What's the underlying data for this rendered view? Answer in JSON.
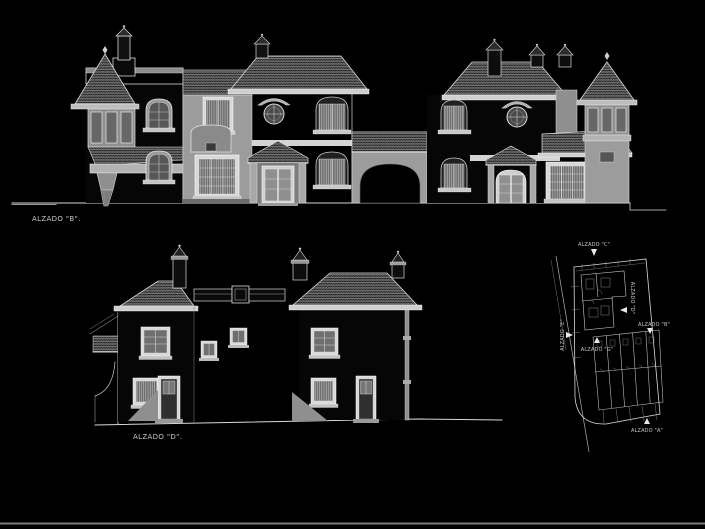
{
  "window": {
    "bottom_edge_color": "#7a7a7a"
  },
  "drawing": {
    "background": "#000000",
    "line_color": "#d9d9d9",
    "wall_fill": "#9c9c9c",
    "roof_tile_line": "#c9c9c9",
    "labels": {
      "elevation_top": "ALZADO \"B\".",
      "elevation_bottom": "ALZADO \"D\"."
    },
    "site_plan": {
      "label_top": "ALZADO \"C\"",
      "label_right_side": "ALZADO \"D\"",
      "label_front_row": "ALZADO \"B\"",
      "label_bottom": "ALZADO \"A\"",
      "label_left_side": "ALZADO \"E\"",
      "label_inner": "ALZADO \"G\""
    }
  }
}
